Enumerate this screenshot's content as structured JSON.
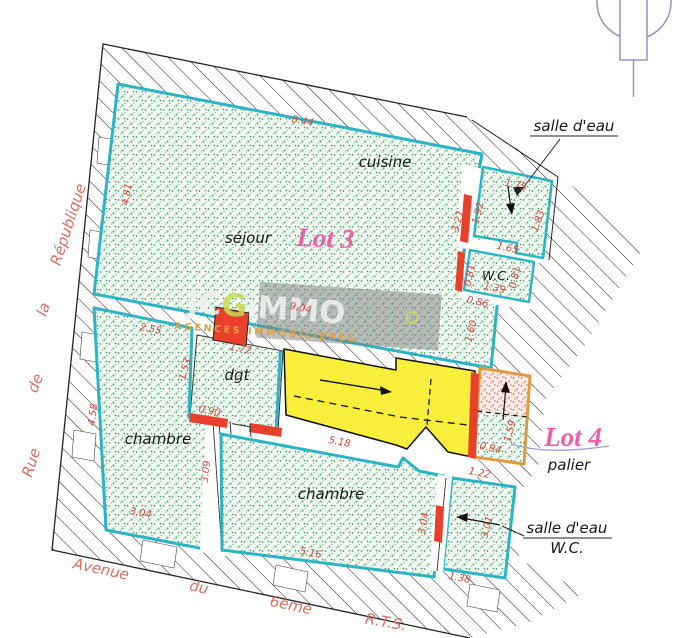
{
  "plan": {
    "lot3_label": "Lot 3",
    "lot4_label": "Lot 4",
    "rooms": {
      "sejour": "séjour",
      "cuisine": "cuisine",
      "dgt": "dgt",
      "chambre_left": "chambre",
      "chambre_right": "chambre",
      "wc": "W.C.",
      "palier": "palier"
    },
    "callouts": {
      "salle_deau_top": "salle d'eau",
      "salle_deau_bottom": "salle d'eau",
      "wc_bottom": "W.C."
    },
    "streets": {
      "left": [
        "Rue",
        "de",
        "la",
        "République"
      ],
      "bottom": [
        "Avenue",
        "du",
        "6ème",
        "R.T.S."
      ]
    },
    "dimensions": {
      "sejour_top": "8.44",
      "sejour_left": "4.81",
      "sejour_bottom": "9.04",
      "sdb_top": "1.75",
      "sdb_left": "1.92",
      "cuisine_right": "3.21",
      "sdb_right": "1.83",
      "sdb_bottom": "1.65",
      "wc_left": "0.81",
      "wc_right": "0.81",
      "wc_bottom": "1.39",
      "below_wc": "0.86",
      "strip_right": "1.60",
      "chambre1_top": "2.55",
      "dgt_top": "1.72",
      "dgt_left": "1.53",
      "dgt_door": "0.90",
      "chambre1_left": "4.58",
      "chambre1_bottom": "3.04",
      "divider": "3.09",
      "bottom_mid": "5.16",
      "chambre2_top": "5.18",
      "strip2_top": "1.22",
      "chambre2_right": "3.04",
      "strip2_right": "3.01",
      "strip2_bottom": "1.38",
      "palier_bottom": "0.94",
      "palier_right": "1.59"
    },
    "watermark": {
      "brand_1": "JC",
      "brand_2": "G",
      "brand_3": "iMMO",
      "tagline": "AGENCES IMMOBILIÈRES"
    },
    "colors": {
      "wall_hatch": "#1a1a1a",
      "room_border": "#2cb4c6",
      "room_dots": "#3aa06b",
      "stairs_yellow": "#f8ee3b",
      "masonry_red": "#e8402a",
      "palier_border": "#e09a40",
      "lot_label_pink": "#ee5fa7",
      "dimension_red": "#d4483b",
      "street_red": "#da6f60",
      "north_symbol": "#8e94c4",
      "watermark_tagline": "#e2a043"
    }
  }
}
